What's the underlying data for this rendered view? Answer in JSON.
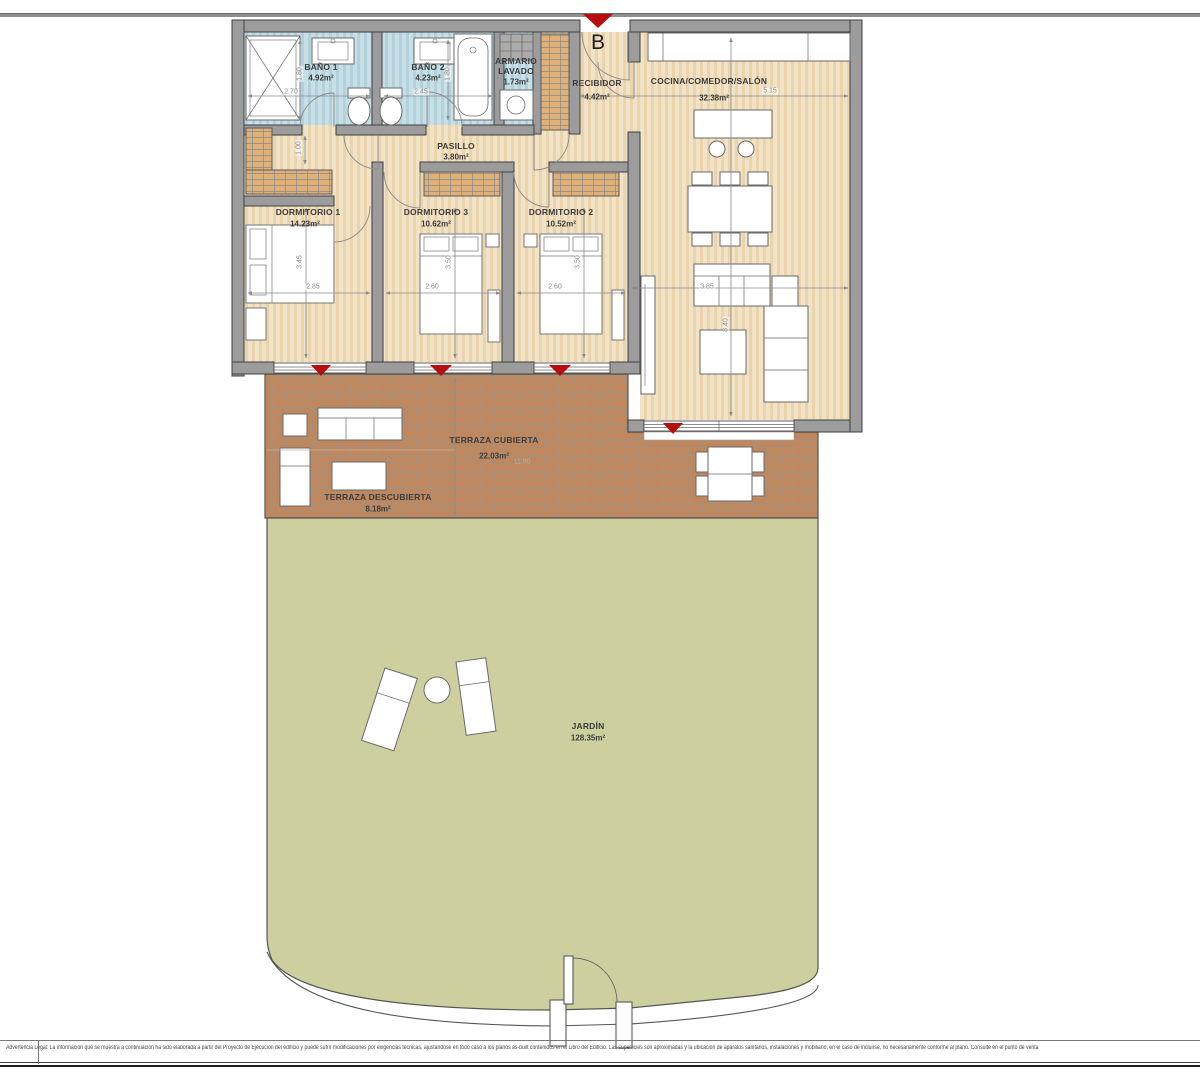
{
  "plan": {
    "entrance_marker": "B",
    "rooms": [
      {
        "name": "BAÑO 1",
        "area": "4.92m²"
      },
      {
        "name": "BAÑO 2",
        "area": "4.23m²"
      },
      {
        "name": "ARMARIO LAVADO",
        "area": "1.73m²"
      },
      {
        "name": "RECIBIDOR",
        "area": "4.42m²"
      },
      {
        "name": "COCINA/COMEDOR/SALÓN",
        "area": "32.38m²"
      },
      {
        "name": "PASILLO",
        "area": "3.80m²"
      },
      {
        "name": "DORMITORIO 1",
        "area": "14.23m²"
      },
      {
        "name": "DORMITORIO 3",
        "area": "10.62m²"
      },
      {
        "name": "DORMITORIO 2",
        "area": "10.52m²"
      },
      {
        "name": "TERRAZA CUBIERTA",
        "area": "22.03m²"
      },
      {
        "name": "TERRAZA DESCUBIERTA",
        "area": "8.18m²"
      },
      {
        "name": "JARDÍN",
        "area": "128.35m²"
      }
    ],
    "dims": {
      "b1_w": "2.70",
      "b1_d": "1.80",
      "b2_w": "2.45",
      "b2_d": "1.80",
      "entry": "1.00",
      "cocina_w": "5.15",
      "d1_d": "3.45",
      "d1_w": "2.85",
      "d3_d": "3.50",
      "d3_w": "2.60",
      "d2_d": "3.50",
      "d2_w": "2.60",
      "salon_w": "3.85",
      "salon_d": "8.40",
      "terraza_w": "11.90"
    }
  },
  "legal": "Advertencia Legal: La información que se muestra a continuación ha sido elaborada a partir del Proyecto de Ejecución del edificio y puede sufrir modificaciones por exigencias técnicas, ajustándose en todo caso a los planos as-built contenidos en el Libro del Edificio. Las superficies son aproximadas y la ubicación de aparatos sanitarios, instalaciones y mobiliario, en el caso de incluirse, no necesariamente conforme al plano. Consulte en el punto de venta",
  "colors": {
    "wall": "#9c9c9c",
    "wall_edge": "#3f3f3f",
    "floor": "#f2e2c6",
    "floor2": "#e9d4ae",
    "bath": "#c7dfe6",
    "bath2": "#b2d1da",
    "closet": "#dfb078",
    "terrace": "#bf875d",
    "terrace_joint": "#99968c",
    "garden": "#cdd09e",
    "outline": "#555555",
    "red": "#b70d0d",
    "dim": "#8a8a8a"
  }
}
